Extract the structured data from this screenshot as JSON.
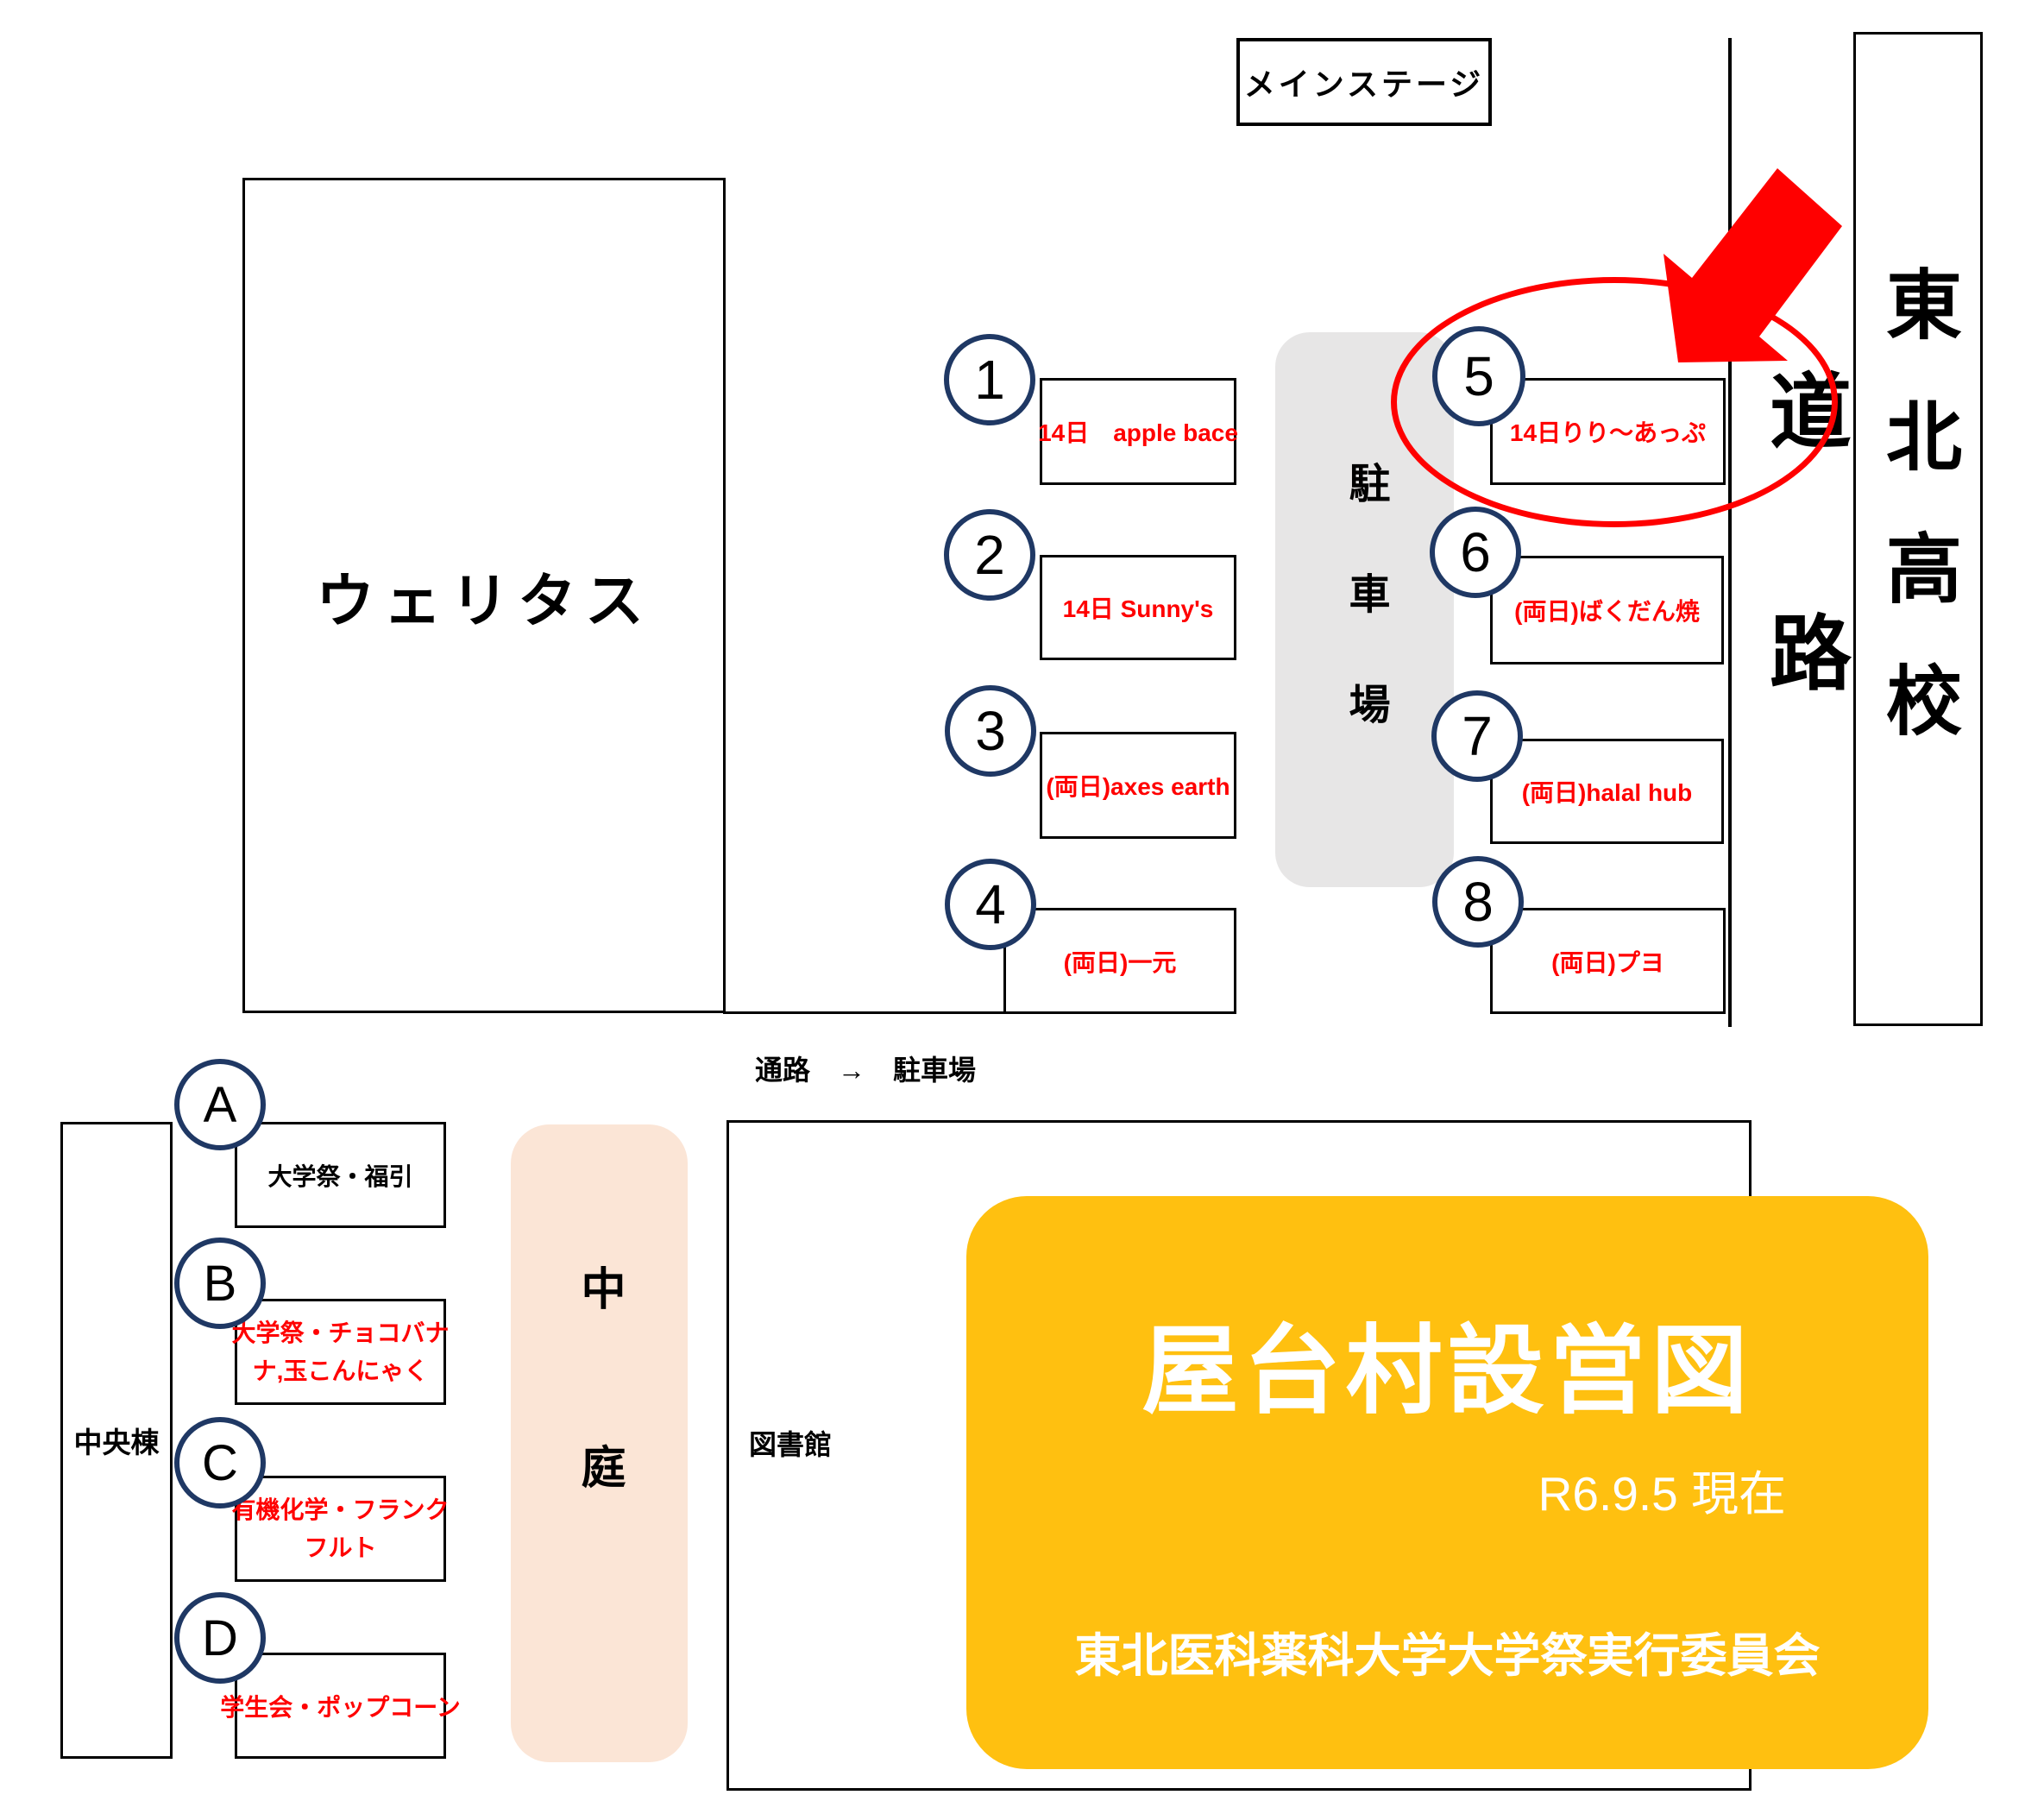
{
  "map": {
    "main_stage": "メインステージ",
    "veritas": "ウェリタス",
    "tohoku_high_school": "東北高校",
    "road": "道路",
    "parking": "駐車場",
    "corridor_note": "通路　→　駐車場",
    "central_building": "中央棟",
    "courtyard": "中庭",
    "library": "図書館"
  },
  "stalls_numbered": [
    {
      "no": "1",
      "label": "14日　apple bace"
    },
    {
      "no": "2",
      "label": "14日 Sunny's"
    },
    {
      "no": "3",
      "label": "(両日)axes earth"
    },
    {
      "no": "4",
      "label": "(両日)一元"
    },
    {
      "no": "5",
      "label": "14日りり～あっぷ"
    },
    {
      "no": "6",
      "label": "(両日)ばくだん焼"
    },
    {
      "no": "7",
      "label": "(両日)halal hub"
    },
    {
      "no": "8",
      "label": "(両日)プヨ"
    }
  ],
  "stalls_lettered": [
    {
      "no": "A",
      "label": "大学祭・福引"
    },
    {
      "no": "B",
      "lines": [
        "大学祭・チョコバナ",
        "ナ,玉こんにゃく"
      ]
    },
    {
      "no": "C",
      "lines": [
        "有機化学・フランク",
        "フルト"
      ]
    },
    {
      "no": "D",
      "label": "学生会・ポップコーン"
    }
  ],
  "legend": {
    "title": "屋台村設営図",
    "as_of": "R6.9.5 現在",
    "committee": "東北医科薬科大学大学祭実行委員会"
  },
  "annotation": {
    "highlighted_stall": "5"
  },
  "colors": {
    "stall_text_red": "#FF0000",
    "circle_navy": "#1F3864",
    "parking_gray": "#E7E6E6",
    "courtyard_peach": "#FBE5D6",
    "legend_orange": "#FFC010",
    "highlight_red": "#FF0000"
  }
}
